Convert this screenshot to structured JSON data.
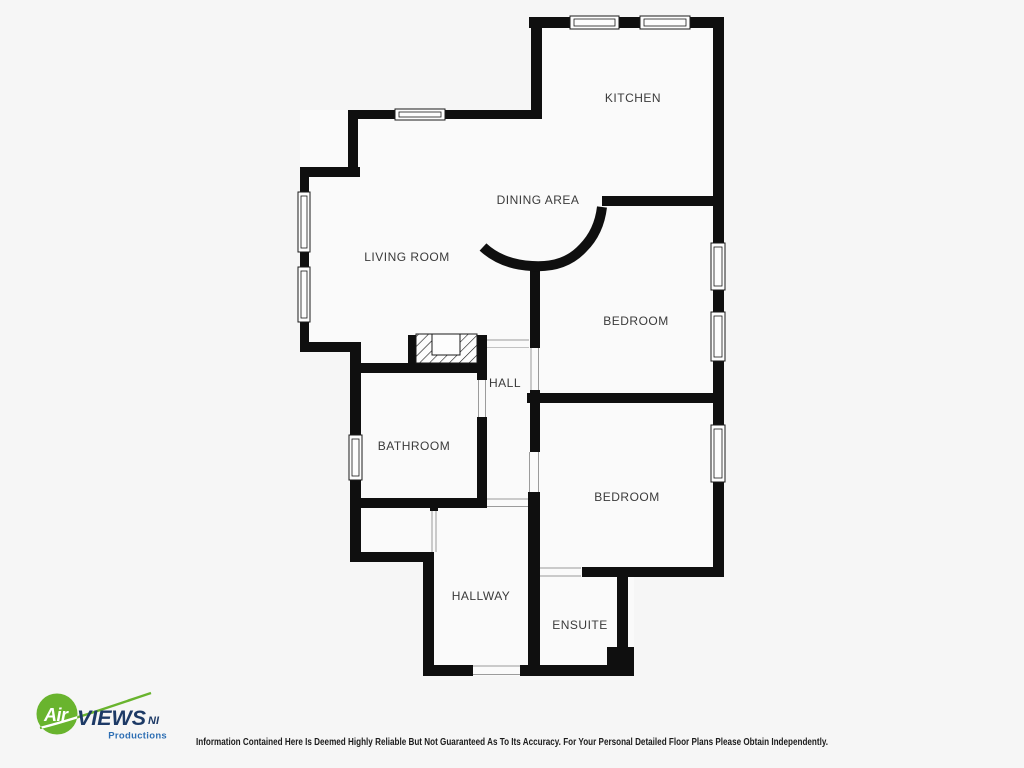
{
  "page": {
    "background": "#f6f6f6",
    "disclaimer": "Information Contained Here Is Deemed Highly Reliable But Not Guaranteed As To Its Accuracy. For Your Personal Detailed Floor Plans Please Obtain Independently."
  },
  "plan": {
    "wall_color": "#0f0f0f",
    "room_fill": "#fafafa",
    "label_color": "#3a3a3a",
    "rooms": [
      {
        "id": "kitchen",
        "label": "KITCHEN"
      },
      {
        "id": "dining-area",
        "label": "DINING AREA"
      },
      {
        "id": "living-room",
        "label": "LIVING ROOM"
      },
      {
        "id": "bedroom-1",
        "label": "BEDROOM"
      },
      {
        "id": "hall",
        "label": "HALL"
      },
      {
        "id": "bathroom",
        "label": "BATHROOM"
      },
      {
        "id": "bedroom-2",
        "label": "BEDROOM"
      },
      {
        "id": "hallway",
        "label": "HALLWAY"
      },
      {
        "id": "ensuite",
        "label": "ENSUITE"
      }
    ]
  },
  "logo": {
    "air": "Air",
    "views": "VIEWS",
    "ni": "NI",
    "productions": "Productions",
    "colors": {
      "green": "#69b42e",
      "navy": "#1d3a66",
      "blue": "#2e6fb4"
    }
  }
}
